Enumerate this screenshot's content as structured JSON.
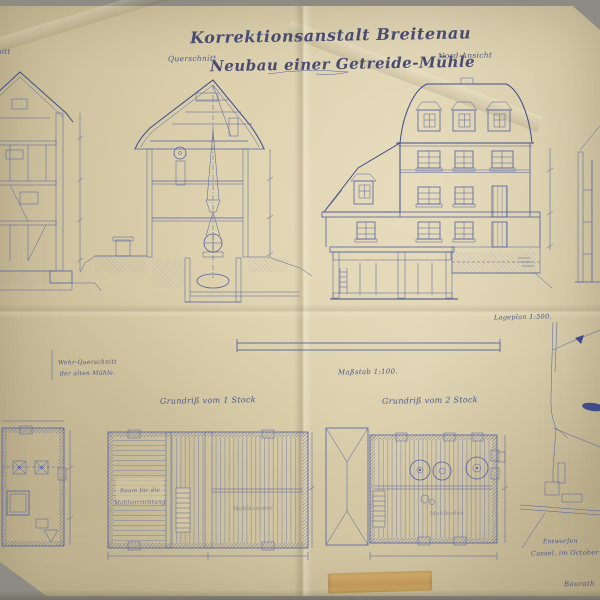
{
  "title": {
    "line1": "Korrektionsanstalt Breitenau",
    "line2": "Neubau einer Getreide-Mühle"
  },
  "labels": {
    "section_left_fragment": "schnitt",
    "querschnitt": "Querschnitt",
    "nord_ansicht": "Nord-Ansicht",
    "lageplan": "Lageplan 1:500.",
    "massstab": "Maßstab 1:100.",
    "grundriss_1": "Grundriß vom 1 Stock",
    "grundriss_2": "Grundriß vom 2 Stock",
    "old_mill_note_line1": "Wehr-Querschnitt",
    "old_mill_note_line2": "der alten Mühle.",
    "room_label_line1": "Raum für die",
    "room_label_line2": "Mahlvorrichtung",
    "mahlkammer": "Mahlkammer",
    "mehlboden": "Mehlboden"
  },
  "signature": {
    "line1": "Entworfen",
    "line2": "Cassel, im October",
    "line3": "Baurath"
  },
  "colors": {
    "paper": "#d4c7a3",
    "ink": "#5260a0",
    "ink_dark": "#3f4c88",
    "title_ink": "#494c72",
    "tape": "#bf9551",
    "backing": "#8d8b83"
  }
}
